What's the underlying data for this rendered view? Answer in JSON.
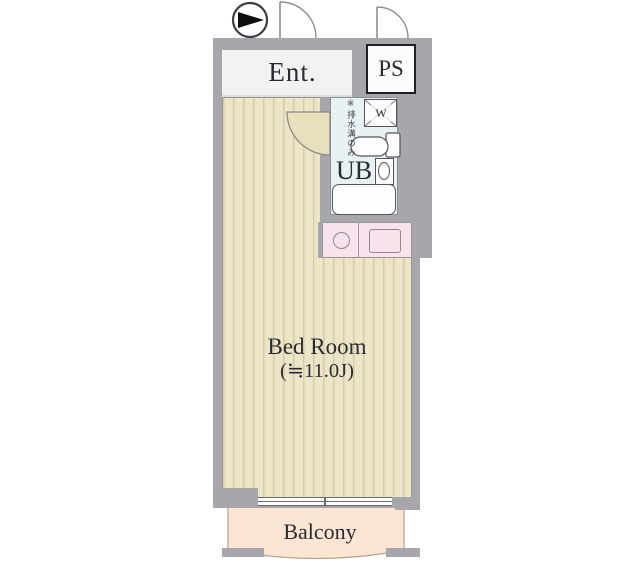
{
  "rooms": {
    "entrance": {
      "label": "Ent."
    },
    "pipe_space": {
      "label": "PS"
    },
    "unit_bath": {
      "label": "UB",
      "washer_label": "W",
      "drain_note": "※排水溝のみ"
    },
    "bedroom": {
      "label": "Bed Room",
      "size": "(≒11.0J)"
    },
    "balcony": {
      "label": "Balcony"
    }
  },
  "icons": {
    "compass": "north-arrow"
  },
  "colors": {
    "wall": "#a6a6ac",
    "floor": "#ede5c8",
    "floor_stripe": "#d6cba4",
    "door_swing": "#e9dfbd",
    "entrance_bg": "#f2f2f2",
    "ps_bg": "#fcfcfc",
    "bath_bg": "#e8f1f4",
    "kitchen_bg": "#f8e3ed",
    "balcony_bg": "#fce5d2",
    "line": "#55555c",
    "text": "#2b2b33"
  }
}
